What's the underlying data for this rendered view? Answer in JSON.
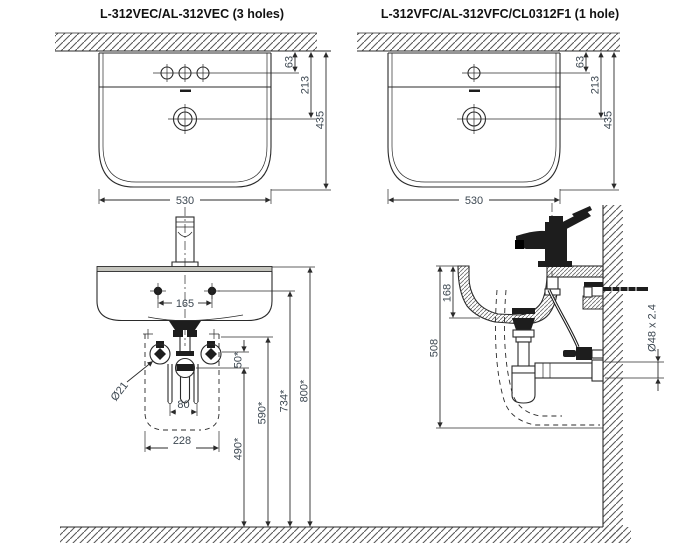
{
  "titles": {
    "left": "L-312VEC/AL-312VEC (3 holes)",
    "right": "L-312VFC/AL-312VFC/CL0312F1 (1 hole)"
  },
  "colors": {
    "line": "#2b2b2b",
    "dim_text": "#3d4852",
    "title_text": "#111111",
    "hatch": "#5a5a5a",
    "rim_gray": "#c4c4bd"
  },
  "views": {
    "front_3hole": {
      "dims": {
        "hole_offset": "63",
        "drain_offset": "213",
        "height": "435",
        "width": "530"
      }
    },
    "front_1hole": {
      "dims": {
        "hole_offset": "63",
        "drain_offset": "213",
        "height": "435",
        "width": "530"
      }
    },
    "install_front": {
      "dims": {
        "mount_spacing": "165",
        "supply_spacing": "80",
        "pedestal_width": "228",
        "valve_gap": "50*",
        "h490": "490*",
        "h590": "590*",
        "h734": "734*",
        "h800": "800*",
        "valve_dia": "Ø21"
      }
    },
    "install_side": {
      "dims": {
        "depth": "168",
        "h508": "508",
        "pipe": "Ø48 x 2.4"
      }
    }
  }
}
